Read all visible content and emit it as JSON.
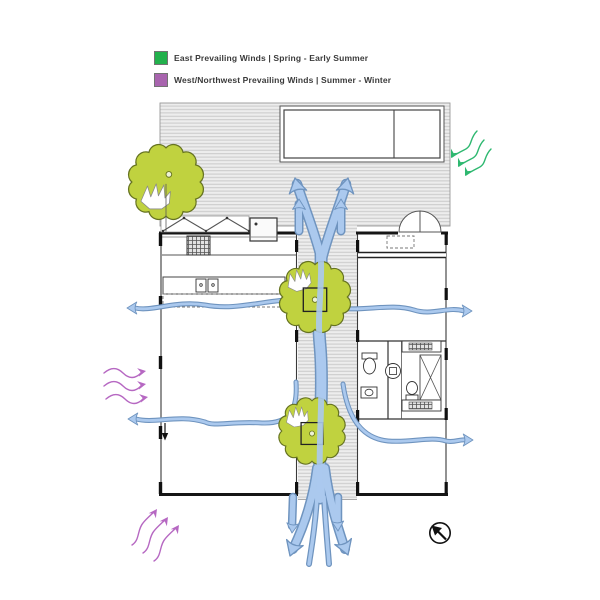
{
  "legend": {
    "items": [
      {
        "label": "East Prevailing Winds | Spring - Early Summer",
        "color": "#22b14c"
      },
      {
        "label": "West/Northwest Prevailing Winds | Summer - Winter",
        "color": "#a864ae"
      }
    ]
  },
  "plan": {
    "type": "architectural-floor-plan-wind-flow-diagram",
    "colors": {
      "breeze_fill": "#abc9ee",
      "breeze_stroke": "#6f94bf",
      "tree_fill": "#c0d23f",
      "tree_stroke": "#667321",
      "east_wind": "#2eb870",
      "west_wind": "#b668c2",
      "deck_fill": "#ececec",
      "wall": "#1c1c1c"
    },
    "icons": {
      "east_wind_arrows": "three wavy arrows entering from the east",
      "west_wind_arrows_mid": "three wavy arrows entering from the west",
      "west_wind_arrows_sw": "three wavy arrows entering from the southwest",
      "breeze_flow": "blue cross-ventilation arrows through breezeway and rooms",
      "trees": "three courtyard trees",
      "north_arrow": "compass arrow pointing upper-left"
    }
  }
}
